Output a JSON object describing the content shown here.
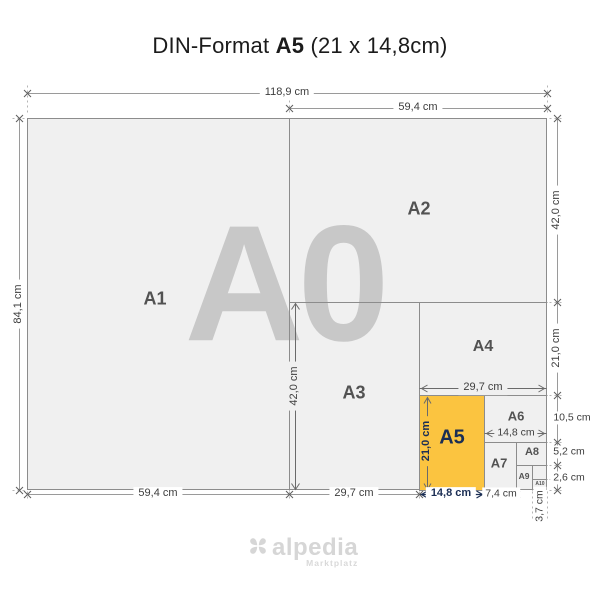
{
  "title": {
    "prefix": "DIN-Format",
    "format": "A5",
    "size": "(21 x 14,8cm)"
  },
  "watermark": "A0",
  "papers": {
    "a1": "A1",
    "a2": "A2",
    "a3": "A3",
    "a4": "A4",
    "a5": "A5",
    "a6": "A6",
    "a7": "A7",
    "a8": "A8",
    "a9": "A9",
    "a10": "A10"
  },
  "dims": {
    "full_width": "118,9 cm",
    "a2_width": "59,4 cm",
    "full_height": "84,1 cm",
    "a2_height": "42,0 cm",
    "a4_height": "21,0 cm",
    "a6_height": "10,5 cm",
    "a8_height": "5,2 cm",
    "a10_height": "2,6 cm",
    "a3_height": "42,0 cm",
    "a4_width": "29,7 cm",
    "a5_height": "21,0 cm",
    "a6_width": "14,8 cm",
    "a1_width": "59,4 cm",
    "a3_width": "29,7 cm",
    "a5_width": "14,8 cm",
    "a7_width": "7,4 cm",
    "a10_width": "3,7 cm"
  },
  "logo": {
    "brand": "alpedia",
    "tagline": "Marktplatz"
  },
  "colors": {
    "highlight": "#FBC440",
    "navy": "#1B2E54",
    "paper": "#F0F0F0",
    "grid_line": "#8C8C8C",
    "dim_line": "#9A9A9A",
    "watermark": "#C8C8C8"
  }
}
